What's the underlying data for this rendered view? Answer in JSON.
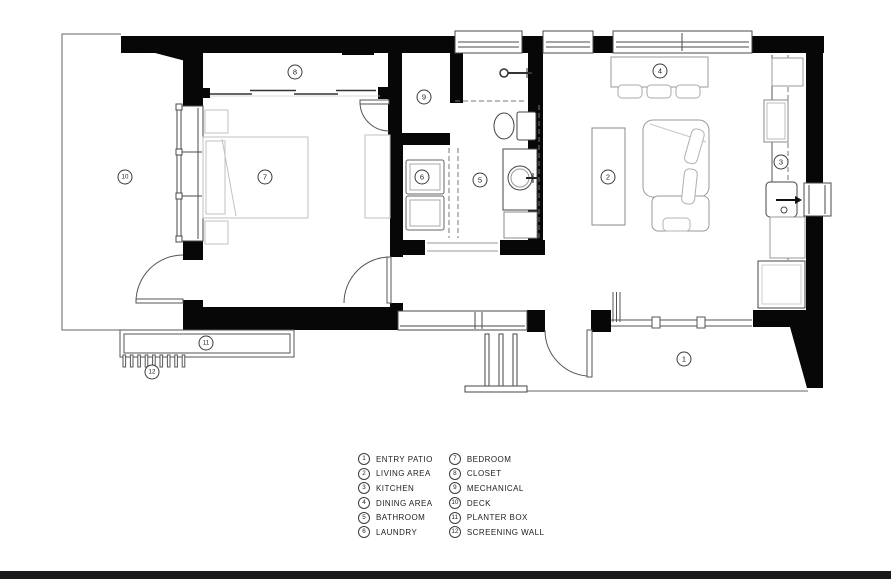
{
  "page": {
    "background": "#ffffff",
    "footer_bar_color": "#1a1a1d"
  },
  "plan": {
    "room_markers": [
      {
        "num": "1",
        "name": "entry-patio",
        "x": 684,
        "y": 359
      },
      {
        "num": "2",
        "name": "living-area",
        "x": 608,
        "y": 177
      },
      {
        "num": "3",
        "name": "kitchen",
        "x": 781,
        "y": 162
      },
      {
        "num": "4",
        "name": "dining-area",
        "x": 660,
        "y": 71
      },
      {
        "num": "5",
        "name": "bathroom",
        "x": 480,
        "y": 180
      },
      {
        "num": "6",
        "name": "laundry",
        "x": 422,
        "y": 177
      },
      {
        "num": "7",
        "name": "bedroom",
        "x": 265,
        "y": 177
      },
      {
        "num": "8",
        "name": "closet",
        "x": 295,
        "y": 72
      },
      {
        "num": "9",
        "name": "mechanical",
        "x": 424,
        "y": 97
      },
      {
        "num": "10",
        "name": "deck",
        "x": 125,
        "y": 177
      },
      {
        "num": "11",
        "name": "planter-box",
        "x": 206,
        "y": 343
      },
      {
        "num": "12",
        "name": "screening-wall",
        "x": 152,
        "y": 372
      }
    ]
  },
  "legend": {
    "items": [
      {
        "num": "1",
        "label": "ENTRY PATIO"
      },
      {
        "num": "2",
        "label": "LIVING AREA"
      },
      {
        "num": "3",
        "label": "KITCHEN"
      },
      {
        "num": "4",
        "label": "DINING AREA"
      },
      {
        "num": "5",
        "label": "BATHROOM"
      },
      {
        "num": "6",
        "label": "LAUNDRY"
      },
      {
        "num": "7",
        "label": "BEDROOM"
      },
      {
        "num": "8",
        "label": "CLOSET"
      },
      {
        "num": "9",
        "label": "MECHANICAL"
      },
      {
        "num": "10",
        "label": "DECK"
      },
      {
        "num": "11",
        "label": "PLANTER BOX"
      },
      {
        "num": "12",
        "label": "SCREENING WALL"
      }
    ]
  }
}
